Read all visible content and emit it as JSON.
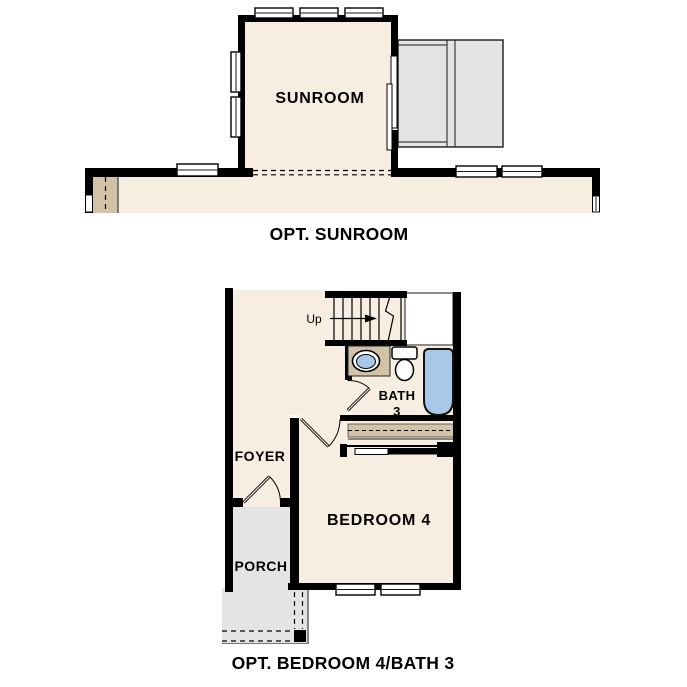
{
  "top_plan": {
    "room_label": "SUNROOM",
    "caption": "OPT. SUNROOM"
  },
  "bottom_plan": {
    "stairs_label": "Up",
    "bath_label_line1": "BATH",
    "bath_label_line2": "3",
    "foyer_label": "FOYER",
    "bedroom_label": "BEDROOM 4",
    "porch_label": "PORCH",
    "caption": "OPT. BEDROOM 4/BATH 3"
  },
  "colors": {
    "wall": "#000000",
    "floor_cream": "#f7eee1",
    "cabinet_tan": "#d2c3a6",
    "concrete_gray": "#e4e4e2",
    "fixture_blue": "#a9c8e8",
    "landing_white": "#ffffff"
  }
}
